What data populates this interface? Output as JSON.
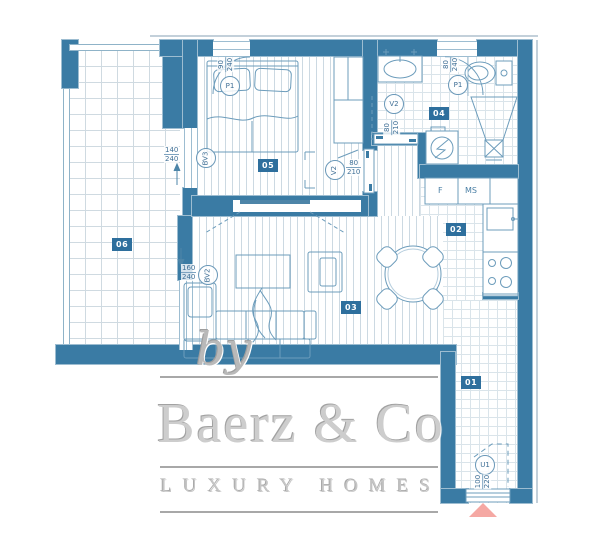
{
  "rooms": {
    "hall": {
      "id": "01"
    },
    "kitchen": {
      "id": "02"
    },
    "living": {
      "id": "03"
    },
    "bath": {
      "id": "04"
    },
    "bedroom": {
      "id": "05"
    },
    "terrace": {
      "id": "06"
    }
  },
  "kitchen_labels": {
    "fridge": "F",
    "dishwasher": "MS"
  },
  "openings": {
    "bedroom_window": {
      "tag": "P1",
      "w": "90",
      "h": "240"
    },
    "bath_window": {
      "tag": "P1",
      "w": "80",
      "h": "240"
    },
    "bath_door": {
      "tag": "V2",
      "w": "80",
      "h": "210"
    },
    "bedroom_door": {
      "tag": "V2",
      "w": "80",
      "h": "210"
    },
    "bedroom_balcony_door": {
      "tag": "BV3",
      "w": "140",
      "h": "240"
    },
    "living_balcony_door": {
      "tag": "BV2",
      "w": "160",
      "h": "240"
    },
    "entrance_door": {
      "tag": "U1",
      "w": "100",
      "h": "220"
    }
  },
  "watermark": {
    "by": "by",
    "brand": "Baerz & Co",
    "tagline": "LUXURY HOMES"
  },
  "colors": {
    "wall": "#3a7ba4",
    "badge": "#2e6f9d",
    "linework": "#6c9cbb",
    "dim_text": "#3f6f96",
    "watermark": "#cdcdcd",
    "entrance_marker": "#f5a8a3"
  }
}
